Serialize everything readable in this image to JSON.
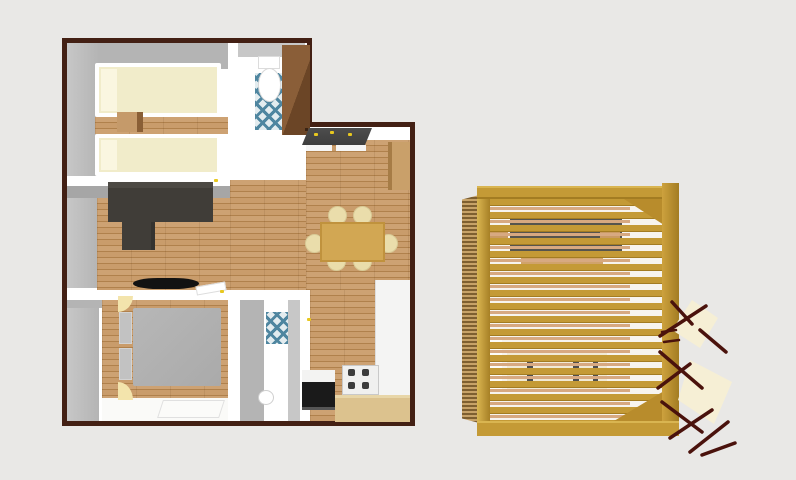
{
  "scene": {
    "type": "3d-floor-plan-render",
    "floor_plan": {
      "rooms": [
        {
          "name": "bedroom-twin",
          "furniture": [
            "single-bed",
            "single-bed",
            "nightstand",
            "wood-floor-strip"
          ]
        },
        {
          "name": "wc",
          "furniture": [
            "toilet",
            "blue-mosaic-tile"
          ]
        },
        {
          "name": "hall-corner",
          "furniture": [
            "wardrobe"
          ]
        },
        {
          "name": "living-room",
          "furniture": [
            "corner-sofa",
            "tv",
            "sideboard",
            "dark-counter"
          ]
        },
        {
          "name": "dining-area",
          "furniture": [
            "dining-table",
            "six-chairs"
          ]
        },
        {
          "name": "kitchen",
          "furniture": [
            "white-counter",
            "gas-stove",
            "black-oven",
            "wood-counter"
          ]
        },
        {
          "name": "bedroom-double",
          "furniture": [
            "double-bed",
            "two-pillows",
            "two-bedside-lamps",
            "white-rug"
          ]
        },
        {
          "name": "bathroom",
          "furniture": [
            "shower-tile",
            "pedestal-sink",
            "door-leaf"
          ]
        }
      ]
    },
    "pergola": {
      "name": "slatted-pergola",
      "seen_through_slats": [
        "dark-table",
        "wood-rails",
        "cream-bench-cushions",
        "side-slat-wall"
      ],
      "outside": [
        "maroon-tree-branches",
        "cream-tree-canopies"
      ]
    }
  },
  "colors": {
    "background": "#e9e8e6",
    "exterior_wall": "#432014",
    "floor_white": "#ffffff",
    "wall_face_light": "#c7c7c7",
    "wall_face_mid": "#b4b4b4",
    "wall_face_dark": "#a6a6a6",
    "wood_light": "#cda273",
    "wood_mid": "#c3945f",
    "wood_mid2": "#c99c6b",
    "wood_dark": "#b0814c",
    "bed_cream": "#f1ecca",
    "pillow_cream": "#faf6e0",
    "nightstand_wood": "#c59a6a",
    "nightstand_side": "#8a5f36",
    "sofa_dark": "#403d38",
    "sofa_light": "#4c4944",
    "tv_black": "#121212",
    "bed_gray": "#aaaaaa",
    "pillow_gray": "#c2c2c2",
    "lamp_cream": "#f3e4ac",
    "rug_white": "#fbfbf9",
    "tile_blue": "#4f86a0",
    "tile_bg": "#e3ecef",
    "wardrobe_brown": "#8a5e38",
    "wardrobe_side": "#6b4526",
    "counter_dark": "#4d4d4d",
    "accent_yellow": "#e8c81f",
    "table_gold": "#d2a753",
    "chair_cream": "#eaddab",
    "appliance_black": "#1a1a1a",
    "stove_white": "#f0f0ef",
    "burner_dark": "#3c3c3c",
    "counter_white": "#f4f4f3",
    "counter_wood": "#dcc28e",
    "cabinet_tan": "#c9a06a",
    "pergola_gold": "#c49a36",
    "pergola_gold_dark": "#a37c22",
    "pergola_gold_light": "#d9b551",
    "pergola_side_light": "#c7a268",
    "pergola_side_dark": "#7e5f30",
    "under_bright": "#f7f4ee",
    "rail_tan": "#d7a981",
    "under_table": "#56554e",
    "cushion_cream": "#f1ead6",
    "cushion_sep": "#4e4e4e",
    "branch_maroon": "#4a120c",
    "canopy_cream": "#f6efd5"
  }
}
